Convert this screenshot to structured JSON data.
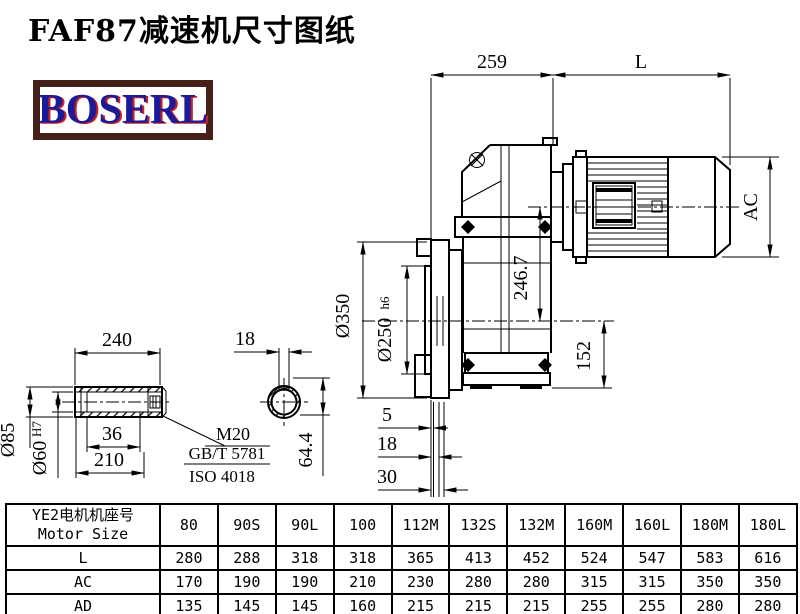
{
  "page": {
    "title": "FAF87减速机尺寸图纸",
    "logo": "BOSERL"
  },
  "colors": {
    "logo_text": "#1b1b99",
    "logo_shadow": "#cc2222",
    "logo_border": "#452018",
    "line": "#000000"
  },
  "dims": {
    "width_259": "259",
    "length_L": "L",
    "ac": "AC",
    "h2467": "246.7",
    "h152": "152",
    "flange_od": "Ø350",
    "spigot": "Ø250",
    "spigot_fit": "h6",
    "off5": "5",
    "off18": "18",
    "off30": "30",
    "shaft_len": "240",
    "shaft_od": "Ø85",
    "bore": "Ø60",
    "bore_fit": "H7",
    "depth36": "36",
    "len210": "210",
    "thread": "M20",
    "std_gb": "GB/T 5781",
    "std_iso": "ISO 4018",
    "key_w": "18",
    "key_h": "64.4"
  },
  "table": {
    "header": {
      "cn": "YE2电机机座号",
      "en": "Motor Size"
    },
    "columns": [
      "80",
      "90S",
      "90L",
      "100",
      "112M",
      "132S",
      "132M",
      "160M",
      "160L",
      "180M",
      "180L"
    ],
    "rows": [
      {
        "label": "L",
        "values": [
          "280",
          "288",
          "318",
          "318",
          "365",
          "413",
          "452",
          "524",
          "547",
          "583",
          "616"
        ]
      },
      {
        "label": "AC",
        "values": [
          "170",
          "190",
          "190",
          "210",
          "230",
          "280",
          "280",
          "315",
          "315",
          "350",
          "350"
        ]
      },
      {
        "label": "AD",
        "values": [
          "135",
          "145",
          "145",
          "160",
          "215",
          "215",
          "215",
          "255",
          "255",
          "280",
          "280"
        ]
      }
    ]
  }
}
